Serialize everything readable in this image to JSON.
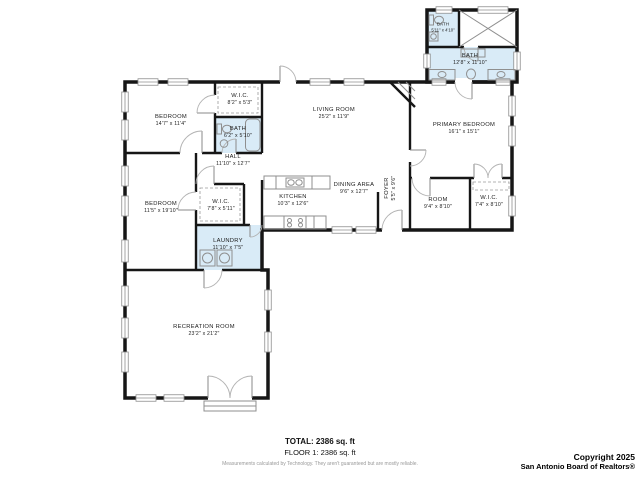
{
  "colors": {
    "wall": "#161616",
    "bath_fill": "#d9ebf7",
    "fixture": "#8f8f8f"
  },
  "rooms": [
    {
      "name": "BEDROOM",
      "dims": "14'7\" x 11'4\""
    },
    {
      "name": "W.I.C.",
      "dims": "8'2\" x 5'3\""
    },
    {
      "name": "BATH",
      "dims": "6'2\" x 5'10\""
    },
    {
      "name": "LIVING ROOM",
      "dims": "25'2\" x 11'9\""
    },
    {
      "name": "PRIMARY BEDROOM",
      "dims": "16'1\" x 15'1\""
    },
    {
      "name": "BATH",
      "dims": "5'11\" x 4'10\""
    },
    {
      "name": "BATH",
      "dims": "12'8\" x 11'10\""
    },
    {
      "name": "HALL",
      "dims": "11'10\" x 12'7\""
    },
    {
      "name": "BEDROOM",
      "dims": "11'5\" x 19'10\""
    },
    {
      "name": "W.I.C.",
      "dims": "7'8\" x 5'11\""
    },
    {
      "name": "KITCHEN",
      "dims": "10'3\" x 12'6\""
    },
    {
      "name": "DINING AREA",
      "dims": "9'6\" x 12'7\""
    },
    {
      "name": "FOYER",
      "dims": "5'5\" x 9'6\""
    },
    {
      "name": "ROOM",
      "dims": "9'4\" x 8'10\""
    },
    {
      "name": "W.I.C.",
      "dims": "7'4\" x 8'10\""
    },
    {
      "name": "LAUNDRY",
      "dims": "11'10\" x 7'5\""
    },
    {
      "name": "RECREATION ROOM",
      "dims": "23'2\" x 21'2\""
    }
  ],
  "footer": {
    "total": "TOTAL: 2386 sq. ft",
    "floor": "FLOOR 1: 2386 sq. ft",
    "disclaimer": "Measurements calculated by Technology. They aren't guaranteed but are mostly reliable.",
    "copyright_line1": "Copyright 2025",
    "copyright_line2": "San Antonio Board of Realtors®"
  }
}
